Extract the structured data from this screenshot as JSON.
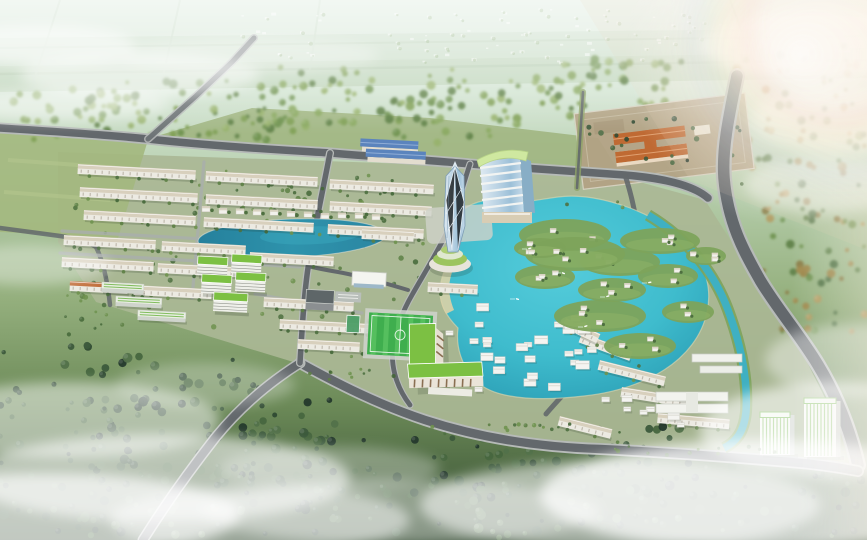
{
  "meta": {
    "title": "Aerial masterplan rendering",
    "description": "Photorealistic aerial 3D rendering of a planned township: grids of white townhouses, green-roofed apartment blocks, a faceted crystal glass tower beside a banded high-rise slab, a bright turquoise lagoon ringed by white villas on green islands, a west lake, a football pitch, an L-shaped apartment building, a walled school site with orange roofs, southeast office towers with green louvers, tree-lined roads, surrounding forest, hazy farmland on the horizon and drifting white clouds."
  },
  "scene": {
    "colors": {
      "haze_top": "#e6f1ea",
      "band_mid": "#b7cfae",
      "band_low": "#7d9c66",
      "band_deep": "#31492f",
      "dev_ground": "#aab795",
      "meadow": "#9db37c",
      "field": "#a3b87e",
      "road": "#63686c",
      "road_casing": "#b6bab8",
      "street": "#a9aeac",
      "wall": "#eceae2",
      "roof_beige": "#d8d0bd",
      "tick": "#b8b2a4",
      "orange_roof": "#c2703d",
      "lake_west": "#2d8fa9",
      "lagoon": "#3fbccd",
      "lagoon_deep": "#2aa2ba",
      "canal": "#3fb0c2",
      "beach": "#dbd2a6",
      "island_green": "#7da35b",
      "green_roof": "#7cc043",
      "pitch": "#3fae4e",
      "pitch_light": "#55bf5e",
      "tower_glass": "#c3d9e8",
      "tower_edge": "#7d9cb4",
      "slab_band": "#f2f4f2",
      "slab_glass": "#8fbcd4",
      "slab_roof": "#cfe8a0",
      "mansion_roof": "#5b84bd",
      "site_ground": "#b3a284",
      "site_roof": "#bf6a33",
      "office_stripe": "#6fb446",
      "cloud": "#ffffff",
      "shadow": "#1e2b1e"
    },
    "landmarks": [
      {
        "name": "crystal-tower",
        "label": "faceted glass tower"
      },
      {
        "name": "banded-high-rise",
        "label": "high-rise slab with curved green roof"
      },
      {
        "name": "round-podium",
        "label": "circular podium with green terraces"
      },
      {
        "name": "main-lagoon",
        "label": "turquoise lagoon with villa islands"
      },
      {
        "name": "west-lake",
        "label": "teal west lake"
      },
      {
        "name": "townhouse-grid",
        "label": "townhouse grid district"
      },
      {
        "name": "apartment-cluster",
        "label": "green-roof apartment cluster"
      },
      {
        "name": "school-campus",
        "label": "striped-roof campus slabs"
      },
      {
        "name": "football-pitch",
        "label": "football pitch"
      },
      {
        "name": "l-shaped-apartment",
        "label": "L-shaped green-roof apartment"
      },
      {
        "name": "blue-roof-mansion",
        "label": "blue-roof mansion"
      },
      {
        "name": "walled-school-site",
        "label": "walled plot with orange-roof building"
      },
      {
        "name": "office-towers",
        "label": "green-louver office towers"
      },
      {
        "name": "arterial-road",
        "label": "curved arterial road with canal"
      },
      {
        "name": "forest-belt",
        "label": "surrounding forest and meadows"
      },
      {
        "name": "distant-village",
        "label": "hazy distant low-rise village"
      },
      {
        "name": "clouds",
        "label": "white clouds and lens flare"
      }
    ]
  }
}
